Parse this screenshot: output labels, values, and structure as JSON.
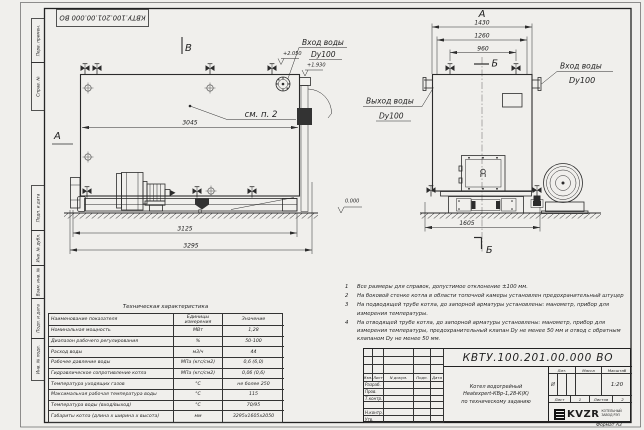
{
  "stamp": {
    "doc_number": "КВТУ.100.201.00.000 ВО"
  },
  "frame": {
    "left_top_cells": [
      "Перв. примен.",
      "Справ. №"
    ],
    "left_bottom_cells": [
      "Подп. и дата",
      "Инв. № дубл.",
      "Взам. инв. №",
      "Подп. и дата",
      "Инв. № подл."
    ],
    "format_label": "Формат  А3"
  },
  "side_view": {
    "mark_top": "В",
    "mark_left": "А",
    "callout": "см. п. 2",
    "dim_body": "3045",
    "dim_frame": "3125",
    "dim_overall": "3295",
    "elev_top": "+2.050",
    "elev_flange": "+1.930",
    "elev_ground": "0.000",
    "inlet_label": "Вход воды",
    "inlet_dn": "Dy100"
  },
  "front_view": {
    "mark_top": "А",
    "section_top": "Б",
    "section_bottom": "Б",
    "dim_overall": "1430",
    "dim_flanges": "1260",
    "dim_valves": "960",
    "dim_base": "1605",
    "outlet_label": "Выход воды",
    "outlet_dn": "Dy100",
    "inlet_label": "Вход воды",
    "inlet_dn": "Dy100"
  },
  "notes": {
    "items": [
      {
        "num": "1",
        "text": "Все размеры для справок, допустимое отклонение ±100 мм."
      },
      {
        "num": "2",
        "text": "На боковой стенке котла в области топочной камеры установлен предохранительный штуцер"
      },
      {
        "num": "3",
        "text": "На подводящей трубе котла, до запорной арматуры установлены: манометр, прибор для измерения температуры."
      },
      {
        "num": "4",
        "text": "На отводящей трубе котла, до запорной арматуры установлены: манометр, прибор для измерения температуры, предохранительный клапан Dу не менее 50 мм и отвод с обратным клапаном Dу не менее 50 мм."
      }
    ]
  },
  "spec": {
    "title": "Техническая характеристика",
    "col_name": "Наименование показателя",
    "col_unit": "Единицы измерения",
    "col_value": "Значение",
    "rows": [
      {
        "name": "Номинальная мощность",
        "unit": "МВт",
        "value": "1,28"
      },
      {
        "name": "Диапазон рабочего регулирования",
        "unit": "%",
        "value": "50-100"
      },
      {
        "name": "Расход воды",
        "unit": "м3/ч",
        "value": "44"
      },
      {
        "name": "Рабочее давление воды",
        "unit": "МПа (кгс/см2)",
        "value": "0,6 (6,0)"
      },
      {
        "name": "Гидравлическое сопротивление котла",
        "unit": "МПа (кгс/см2)",
        "value": "0,06 (0,6)"
      },
      {
        "name": "Температура уходящих газов",
        "unit": "°С",
        "value": "не более 250"
      },
      {
        "name": "Максимальная рабочая температура воды",
        "unit": "°С",
        "value": "115"
      },
      {
        "name": "Температура воды (вход/выход)",
        "unit": "°С",
        "value": "70/95"
      },
      {
        "name": "Габариты котла (длина х ширина х высота)",
        "unit": "мм",
        "value": "3295х1605х2050"
      }
    ]
  },
  "title_block": {
    "doc_number": "КВТУ.100.201.00.000  ВО",
    "name_line1": "Котел водогрейный",
    "name_line2": "Heatexpert-КВр-1,28-К(К)",
    "name_line3": "по техническому заданию",
    "rev_headers": [
      "Изм.",
      "Лист",
      "N докум.",
      "Подп.",
      "Дата"
    ],
    "sig_labels": [
      "Разраб.",
      "Пров.",
      "Т.контр.",
      "",
      "Н.контр.",
      "Утв."
    ],
    "lit_header": "Лит.",
    "mass_header": "Масса",
    "scale_header": "Масштаб",
    "lit_value": "И",
    "scale_value": "1:20",
    "sheet_label": "Лист",
    "sheet_value": "1",
    "sheets_label": "Листов",
    "sheets_value": "2",
    "logo_text": "KVZR",
    "company_line1": "КОТЕЛЬНЫЙ",
    "company_line2": "ЗАВОД РЭП"
  }
}
